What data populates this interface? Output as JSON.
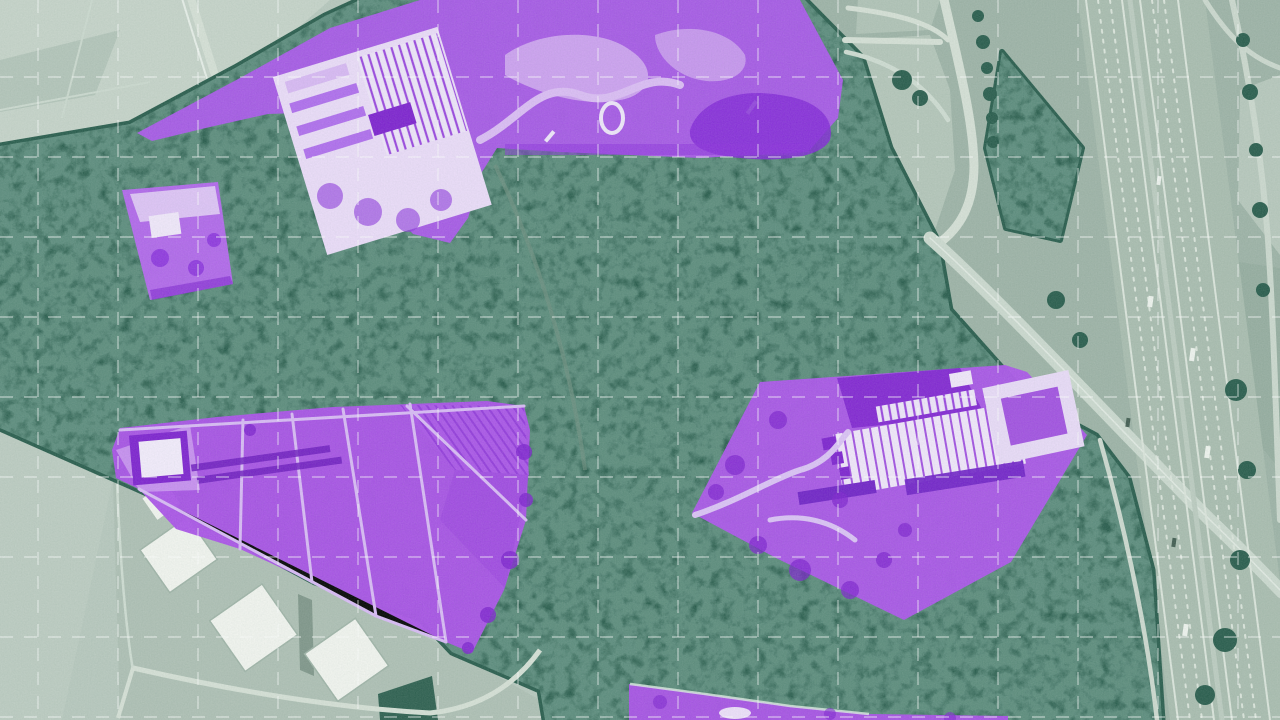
{
  "view": {
    "width": 1280,
    "height": 720,
    "kind": "aerial-satellite-imagery",
    "treatment": "green-duotone with purple land-parcel segmentation overlays and dashed reference grid"
  },
  "palette": {
    "field_base": "#b7c7bd",
    "field_light": "#c6d3c9",
    "field_mid": "#a2b7ab",
    "right_panel": "#9db2a6",
    "forest": "#265a4a",
    "forest_light": "#35695a",
    "road_light": "#d6e0d6",
    "road_bright": "#e8efe9",
    "highway_base": "#a9bcaf",
    "lane_line": "#dce5dc",
    "building_white": "#f3f5f0",
    "overlay_purple": "#a855e8",
    "overlay_purple_dark": "#7d1fd0",
    "overlay_purple_deep": "#6d18c0",
    "overlay_purple_mid": "#8a2ede",
    "overlay_purple_light": "#d2a9f2",
    "overlay_purple_pale": "#ecdcfa",
    "grid_line": "#ffffff"
  },
  "grid": {
    "spacing_x": 80,
    "spacing_y": 80,
    "offset_x": 38,
    "offset_y": 77,
    "dash": "13 11",
    "opacity": 0.5,
    "stroke_width": 1.4
  },
  "regions": [
    {
      "id": "park-complex-north",
      "fill": "#a957ea",
      "opacity": 0.97,
      "points": "137,133 240,78 330,28 420,0 800,0 843,80 838,118 808,152 700,158 560,152 497,148 482,172 468,218 450,243 413,234 384,203 356,158 330,112 268,114 210,127 152,141"
    },
    {
      "id": "small-site-west",
      "fill": "#b565ef",
      "opacity": 0.97,
      "points": "122,190 218,182 233,284 150,300"
    },
    {
      "id": "farmland-wedge-southwest",
      "fill": "#aa4fe9",
      "opacity": 0.97,
      "points": "120,428 217,417 333,407 487,401 524,406 530,430 526,520 504,590 472,653 446,642 376,616 312,582 240,549 176,529 139,489 116,478 112,450"
    },
    {
      "id": "greenhouse-site-east",
      "fill": "#ab54ea",
      "opacity": 0.97,
      "points": "692,513 760,382 1005,365 1027,372 1087,435 1011,562 904,620 776,558"
    },
    {
      "id": "site-sliver-south",
      "fill": "#a94fe8",
      "opacity": 0.97,
      "points": "629,684 705,694 790,706 869,714 1008,716 1008,720 629,720"
    }
  ]
}
